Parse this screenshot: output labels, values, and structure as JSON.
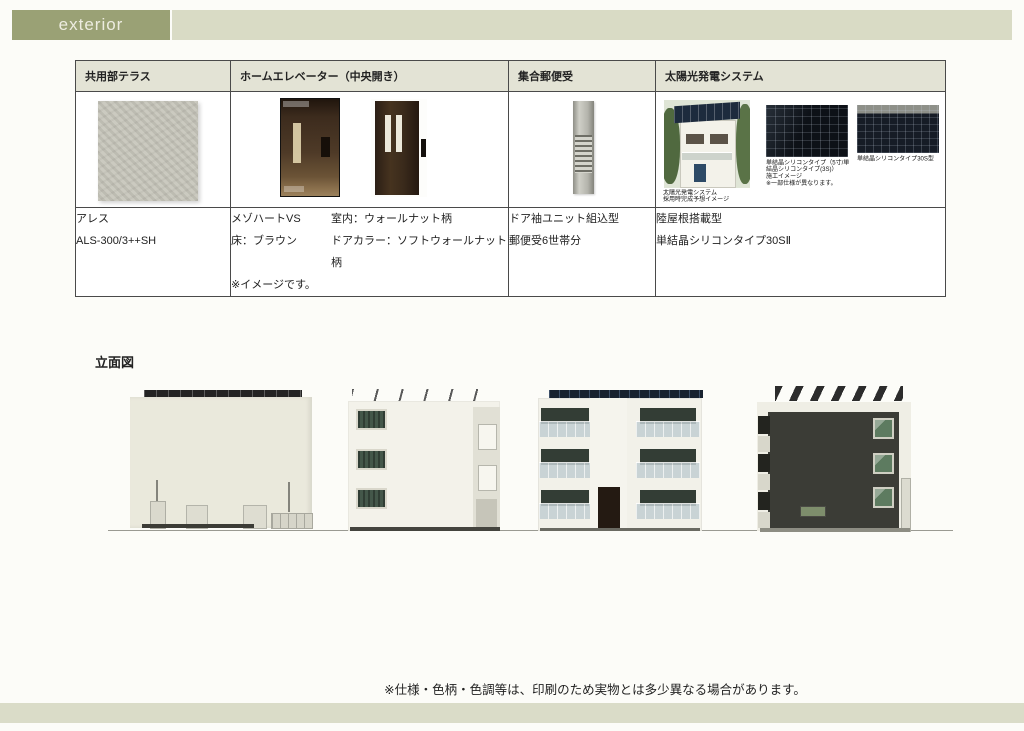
{
  "header": {
    "label": "exterior"
  },
  "spec_table": {
    "columns": [
      {
        "title": "共用部テラス"
      },
      {
        "title": "ホームエレベーター（中央開き）"
      },
      {
        "title": "集合郵便受"
      },
      {
        "title": "太陽光発電システム"
      }
    ],
    "terrace": {
      "product": "アレス",
      "model": "ALS-300/3++SH"
    },
    "elevator": {
      "name": "メゾハートVS",
      "interior": "室内：ウォールナット柄",
      "floor": "床：ブラウン",
      "door_color": "ドアカラー：ソフトウォールナット柄",
      "note": "※イメージです。"
    },
    "mailbox": {
      "type": "ドア袖ユニット組込型",
      "capacity": "郵便受6世帯分"
    },
    "solar": {
      "mount": "陸屋根搭載型",
      "panel_type": "単結晶シリコンタイプ30SⅡ",
      "caption1": [
        "太陽光発電システム",
        "採用時完成予想イメージ"
      ],
      "caption2": [
        "単結晶シリコンタイプ（5寸/単",
        "結晶シリコンタイプ(3S)）",
        "施工イメージ",
        "※一部仕様が異なります。"
      ],
      "caption3": [
        "単結晶シリコンタイプ30S型"
      ]
    }
  },
  "elevation": {
    "label": "立面図"
  },
  "footer": {
    "note": "※仕様・色柄・色調等は、印刷のため実物とは多少異なる場合があります。"
  },
  "colors": {
    "accent_olive": "#9aa175",
    "bar_olive": "#d9dbc5",
    "table_header": "#e3e3d5"
  }
}
